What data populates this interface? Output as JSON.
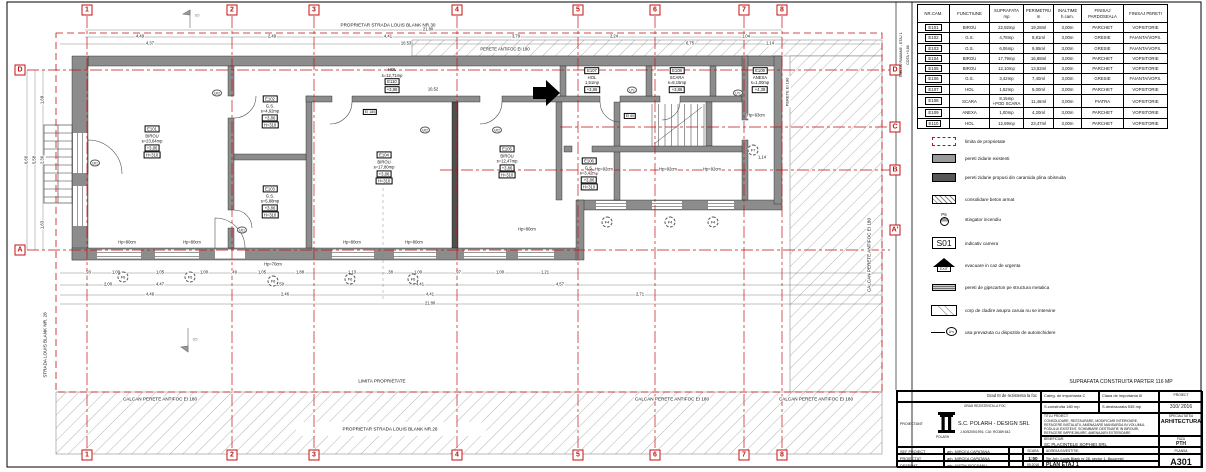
{
  "plan": {
    "grid": {
      "cols": [
        "1",
        "2",
        "3",
        "4",
        "5",
        "6",
        "7",
        "8"
      ],
      "left": [
        "D",
        "A"
      ],
      "right": [
        "D",
        "C",
        "B",
        "A'"
      ]
    },
    "texts": {
      "top_owner": "PROPRIETAR STRADA LOUIS BLANK NR.30",
      "top_wall": "PERETE ANTIFOC EI 180",
      "limita": "LIMITA PROPRIETATE",
      "calcan": "CALCAN PERETE ANTIFOC EI 180",
      "bottom_owner": "PROPRIETAR STRADA LOUIS BLANK NR.26",
      "street": "STRADA LOUIS BLANK NR. 28",
      "perete_right": "PERETE EI 180",
      "tablou_1": "TABLOU RAMANE - ETAJ 1",
      "tablou_2": "COTA +3,86",
      "section": "S5"
    },
    "rooms": [
      {
        "id": "E101",
        "name": "BIROU",
        "area": "s=23,64mp",
        "lvl": "+3,86",
        "h": "H=310"
      },
      {
        "id": "E102",
        "name": "G.S.",
        "area": "s=4,62mp",
        "lvl": "+3,86",
        "h": "H=310"
      },
      {
        "id": "E103",
        "name": "G.S.",
        "area": "s=5,88mp",
        "lvl": "+3,86",
        "h": "H=310"
      },
      {
        "id": "E104",
        "name": "BIROU",
        "area": "s=17,80mp",
        "lvl": "+3,86",
        "h": "H=310"
      },
      {
        "id": "E105",
        "name": "BIROU",
        "area": "s=12,47mp",
        "lvl": "+3,86",
        "h": "H=310"
      },
      {
        "id": "E106",
        "name": "G.S.",
        "area": "s=3,42mp",
        "lvl": "+3,86",
        "h": "H=310"
      },
      {
        "id": "E107",
        "name": "HOL",
        "area": "1,51mp",
        "lvl": "+3,86",
        "h": ""
      },
      {
        "id": "E108",
        "name": "SCARA",
        "area": "s=8,15mp",
        "lvl": "+3,86",
        "h": ""
      },
      {
        "id": "E109",
        "name": "ANEXA",
        "area": "s=1,00mp",
        "lvl": "+4,39",
        "h": ""
      },
      {
        "id": "E110",
        "name": "HOL",
        "area": "s=12,71mp",
        "lvl": "+3,86",
        "h": ""
      }
    ],
    "dims": {
      "top1": [
        "4,49",
        "2,49",
        "4,41",
        "3,79",
        "2,24",
        "1,04"
      ],
      "top2": [
        "4,37",
        "10,53",
        "6,75",
        "1,14"
      ],
      "top_total": "21,80",
      "inner": "10,52",
      "bottom1": [
        ",93",
        "1,00",
        "1,05",
        "1,00",
        ",49",
        "1,05",
        "1,88",
        "1,13",
        ",38",
        "1,00",
        ",97",
        "1,00",
        "1,21"
      ],
      "bottom2": [
        "2,00",
        "4,47",
        "2,50",
        "4,41",
        "4,57"
      ],
      "bottom3": [
        "4,49",
        "2,46",
        "4,41",
        "2,71"
      ],
      "bottom_total": "21,80",
      "left": [
        "6,66",
        "5,58",
        "1,69",
        "2,36",
        "1,63"
      ],
      "right": "1,14"
    },
    "hp": [
      "Hp=80cm",
      "Hp=80cm",
      "Hp=80cm",
      "Hp=80cm",
      "Hp=80cm",
      "Hp=92cm",
      "Hp=92cm",
      "Hp=92cm",
      "Hp=93cm",
      "Hp=70cm"
    ],
    "cols_tags": [
      "F6",
      "F6",
      "F6",
      "F6",
      "F6",
      "F4",
      "F4",
      "F4",
      "F7"
    ],
    "door_tags": [
      "U02",
      "U02",
      "U02",
      "U01",
      "U01",
      "U*c",
      "U*c"
    ],
    "fire": [
      "EI 180",
      "EI 60"
    ]
  },
  "room_table": {
    "headers": [
      "NR.CAM.",
      "FUNCTIUNE",
      "SUPRAFATA mp",
      "PERIMETRU m",
      "INALTIME h.cam.",
      "FINISAJ PARDOSEALA",
      "FINISAJ PERETI"
    ],
    "rows": [
      [
        "E101",
        "BIROU",
        "22,92mp",
        "19,28ml",
        "3,00m",
        "PARCHET",
        "VOPSITORIE"
      ],
      [
        "E102",
        "G.S.",
        "4,78mp",
        "8,81ml",
        "3,00m",
        "GRESIE",
        "FAIANTA/VOPS."
      ],
      [
        "E103",
        "G.S.",
        "6,06mp",
        "9,85ml",
        "3,00m",
        "GRESIE",
        "FAIANTA/VOPS."
      ],
      [
        "E104",
        "BIROU",
        "17,79mp",
        "16,88ml",
        "3,00m",
        "PARCHET",
        "VOPSITORIE"
      ],
      [
        "E105",
        "BIROU",
        "12,10mp",
        "13,92ml",
        "3,00m",
        "PARCHET",
        "VOPSITORIE"
      ],
      [
        "E106",
        "G.S.",
        "3,42mp",
        "7,40ml",
        "3,00m",
        "GRESIE",
        "FAIANTA/VOPS."
      ],
      [
        "E107",
        "HOL",
        "1,52mp",
        "5,00ml",
        "3,00m",
        "PARCHET",
        "VOPSITORIE"
      ],
      [
        "E108",
        "SCARA",
        "8,15mp\n+POD SCARA",
        "11,46ml",
        "3,00m",
        "PIATRA",
        "VOPSITORIE"
      ],
      [
        "E109",
        "ANEXA",
        "1,00mp",
        "4,20ml",
        "3,00m",
        "PARCHET",
        "VOPSITORIE"
      ],
      [
        "E110",
        "HOL",
        "12,69mp",
        "23,47ml",
        "3,00m",
        "PARCHET",
        "VOPSITORIE"
      ]
    ]
  },
  "legend": {
    "items": [
      {
        "label": "limita de proprietate",
        "tag": ""
      },
      {
        "label": "pereti zidarie existenti",
        "tag": ""
      },
      {
        "label": "pereti zidarie propusi din caramida plina obisnuita",
        "tag": ""
      },
      {
        "label": "consolidare beton armat",
        "tag": ""
      },
      {
        "label": "stingator incendiu",
        "tag": "P6"
      },
      {
        "label": "indicativ camera",
        "tag": "S01"
      },
      {
        "label": "evacuare in caz de urgenta",
        "tag": "EXIT"
      },
      {
        "label": "pereti de gipscarton pe structura metalica",
        "tag": ""
      },
      {
        "label": "corp de cladire asupra caruia nu se intervine",
        "tag": ""
      },
      {
        "label": "usa prevazuta cu dispozitiv de autoinchidere",
        "tag": "U*c"
      }
    ]
  },
  "panel": {
    "suprafata_line": "SUPRAFATA CONSTRUITA PARTER 116 MP"
  },
  "title_block": {
    "grad": "Grad III de rezistenta la foc",
    "categ": "Categ. de importanta C",
    "clasa": "Clasa de importanta III",
    "proiect_label": "PROIECT",
    "proiect_nr": "310/ 2016",
    "s_construita": "S.construita 180 mp",
    "s_desfasurata": "S.desfasurata 535 mp",
    "grad_small": "GRAD REZISTENTA LA FOC",
    "proiectant_label": "PROIECTANT",
    "firm": "S.C. POLARH - DESIGN SRL",
    "firm_reg": "J 40/5205/1991; CUI: RO389 642",
    "firm_logo_text": "POLARH",
    "titlu_label": "TITLU PROIECT:",
    "titlu": "CONSOLIDARE, RESTAURARE, MODIFICARI INTERIOARE, REFACERE INSTALATII, AMENAJARE MANSARDA IN VOLUMUL PODULUI EXISTENT, SCHIMBARE DESTINATIE IN BIROURI, REFACERE IMPREJMUIRE, AMENAJARI EXTERIOARE",
    "specialitatea_label": "SPECIALITATEA",
    "specialitatea": "ARHITECTURA",
    "beneficiar_label": "BENEFICIAR:",
    "beneficiar": "SC PLACINTELE SOPHIEI SRL",
    "faza_label": "FAZA",
    "faza": "PTH",
    "rows": [
      {
        "label": "SEF PROIECT",
        "name": "arh. MIRCEA CAPATANA"
      },
      {
        "label": "PROIECTAT",
        "name": "arh. MIRCEA CAPATANA"
      },
      {
        "label": "DESENAT",
        "name": "arh. IUSTIN ROCSANU"
      }
    ],
    "scara_label": "SCARA",
    "scara": "1:50",
    "data": "09.2016",
    "adresa_label": "ADRESA INVESTITIE:",
    "adresa": "Str. Arh. Louis Blank nr 28, sector 1, Bucuresti",
    "plan_title": "PLAN ETAJ 1",
    "plansa_label": "PLANSA",
    "plansa": "A301"
  }
}
